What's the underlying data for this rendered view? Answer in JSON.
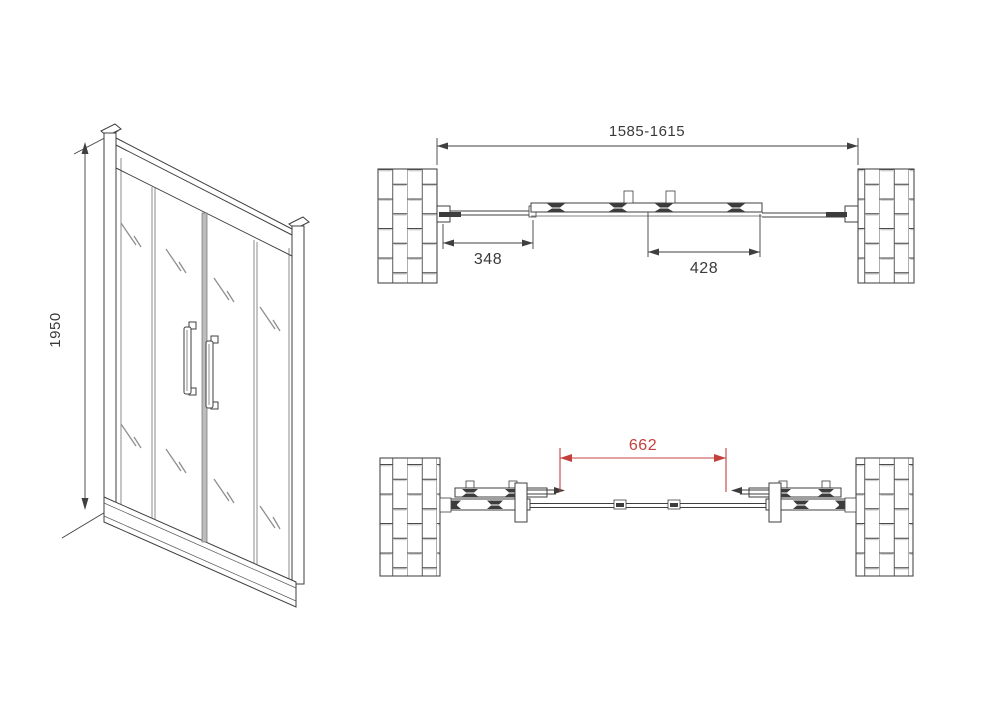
{
  "document": {
    "kind": "shower-door-technical-drawing",
    "background": "#ffffff"
  },
  "colors": {
    "line": "#3f3f3f",
    "dimension_red": "#c4403c",
    "glass_mark": "#8f8f8f"
  },
  "views": {
    "isometric": {
      "description": "front isometric view of 4-panel sliding door",
      "height_dim": "1950"
    },
    "plan_closed": {
      "description": "top plan view, doors closed, between two brick walls",
      "total_width_dim": "1585-1615",
      "left_fixed_panel_dim": "348",
      "sliding_panel_dim": "428"
    },
    "plan_open": {
      "description": "top plan view, doors slid open to walls",
      "opening_width_dim": "662"
    }
  }
}
